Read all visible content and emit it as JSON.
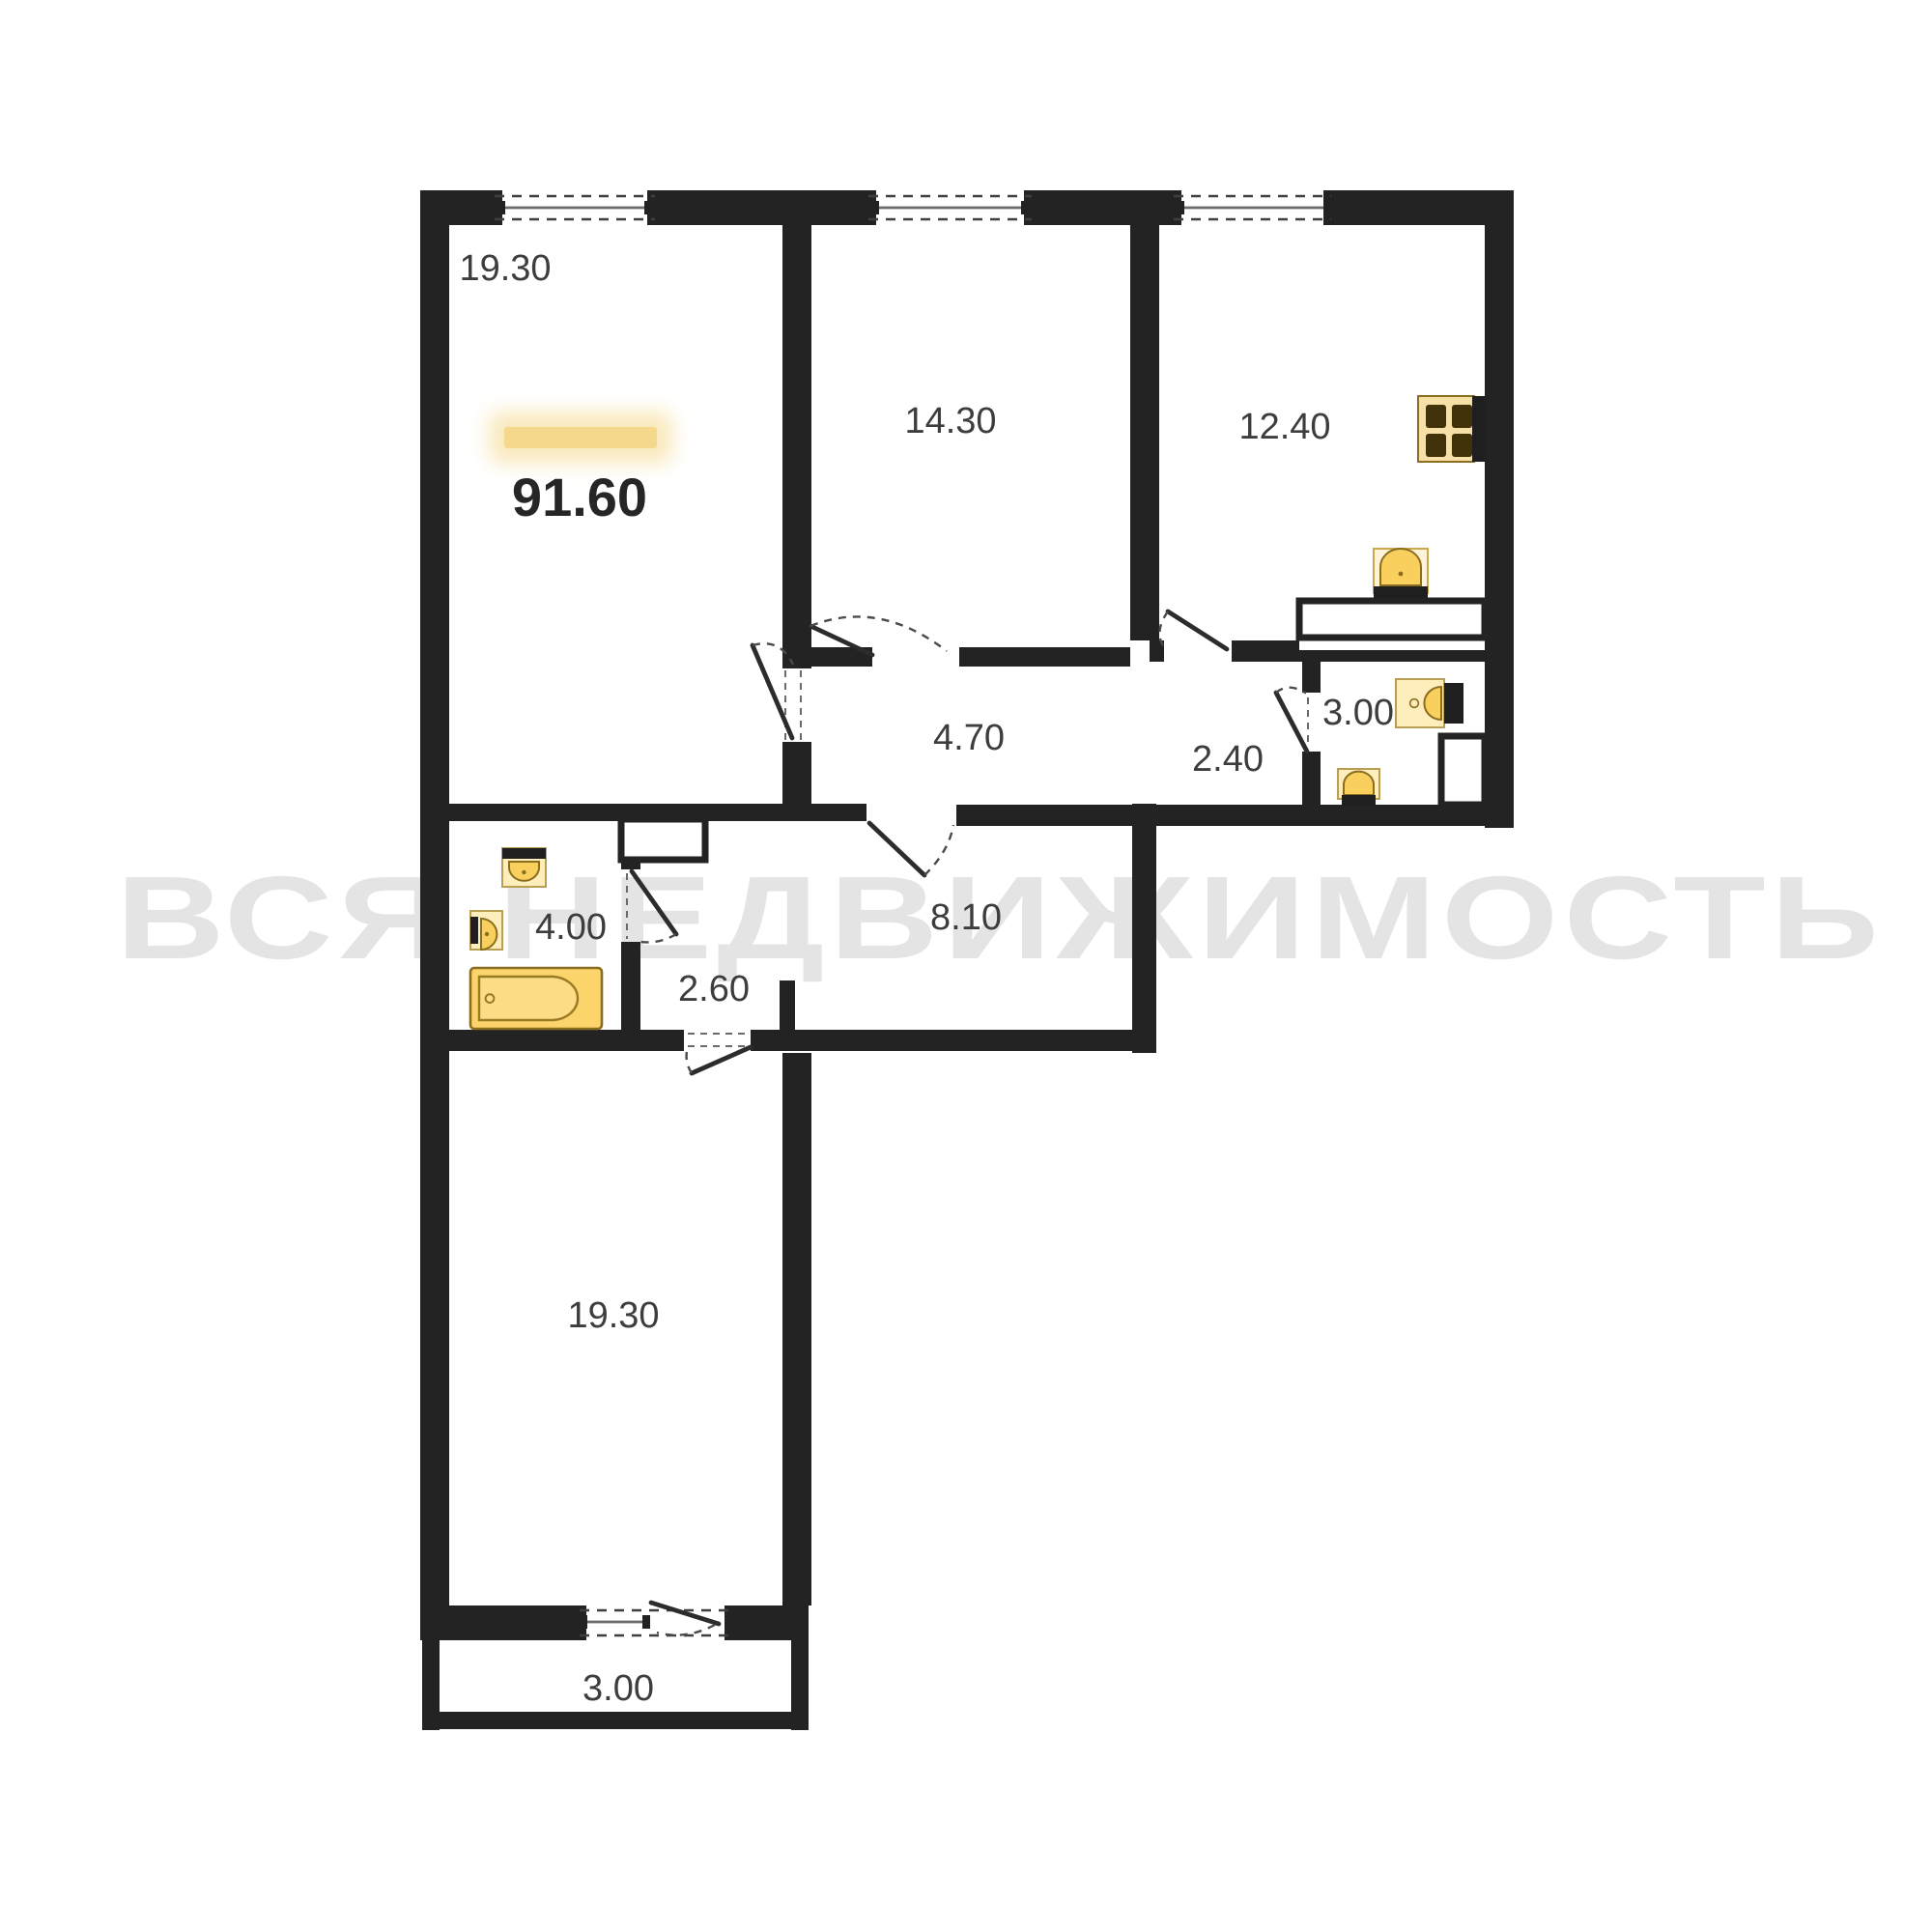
{
  "watermark": {
    "text": "ВСЯ НЕДВИЖИМОСТЬ",
    "color": "#e4e4e4"
  },
  "plan": {
    "total_area": "91.60",
    "rooms": {
      "living_top": "19.30",
      "bedroom": "14.30",
      "kitchen": "12.40",
      "corridor": "4.70",
      "hall_entry": "2.40",
      "wc": "3.00",
      "bathroom": "4.00",
      "hall_inner": "2.60",
      "hallway": "8.10",
      "living_bottom": "19.30",
      "balcony": "3.00"
    },
    "colors": {
      "wall": "#232323",
      "label_text": "#3d3d3d",
      "total_text": "#262626",
      "highlight_bar": "#f5d88c",
      "highlight_glow": "#f8e5b0",
      "fixture_yellow": "#f9cf5e",
      "fixture_light": "#fdeebc",
      "fixture_outline": "#8a6d1f"
    },
    "icons": [
      "stove-icon",
      "sink-icon",
      "toilet-icon",
      "bathtub-icon",
      "window-icon",
      "door-icon"
    ]
  }
}
